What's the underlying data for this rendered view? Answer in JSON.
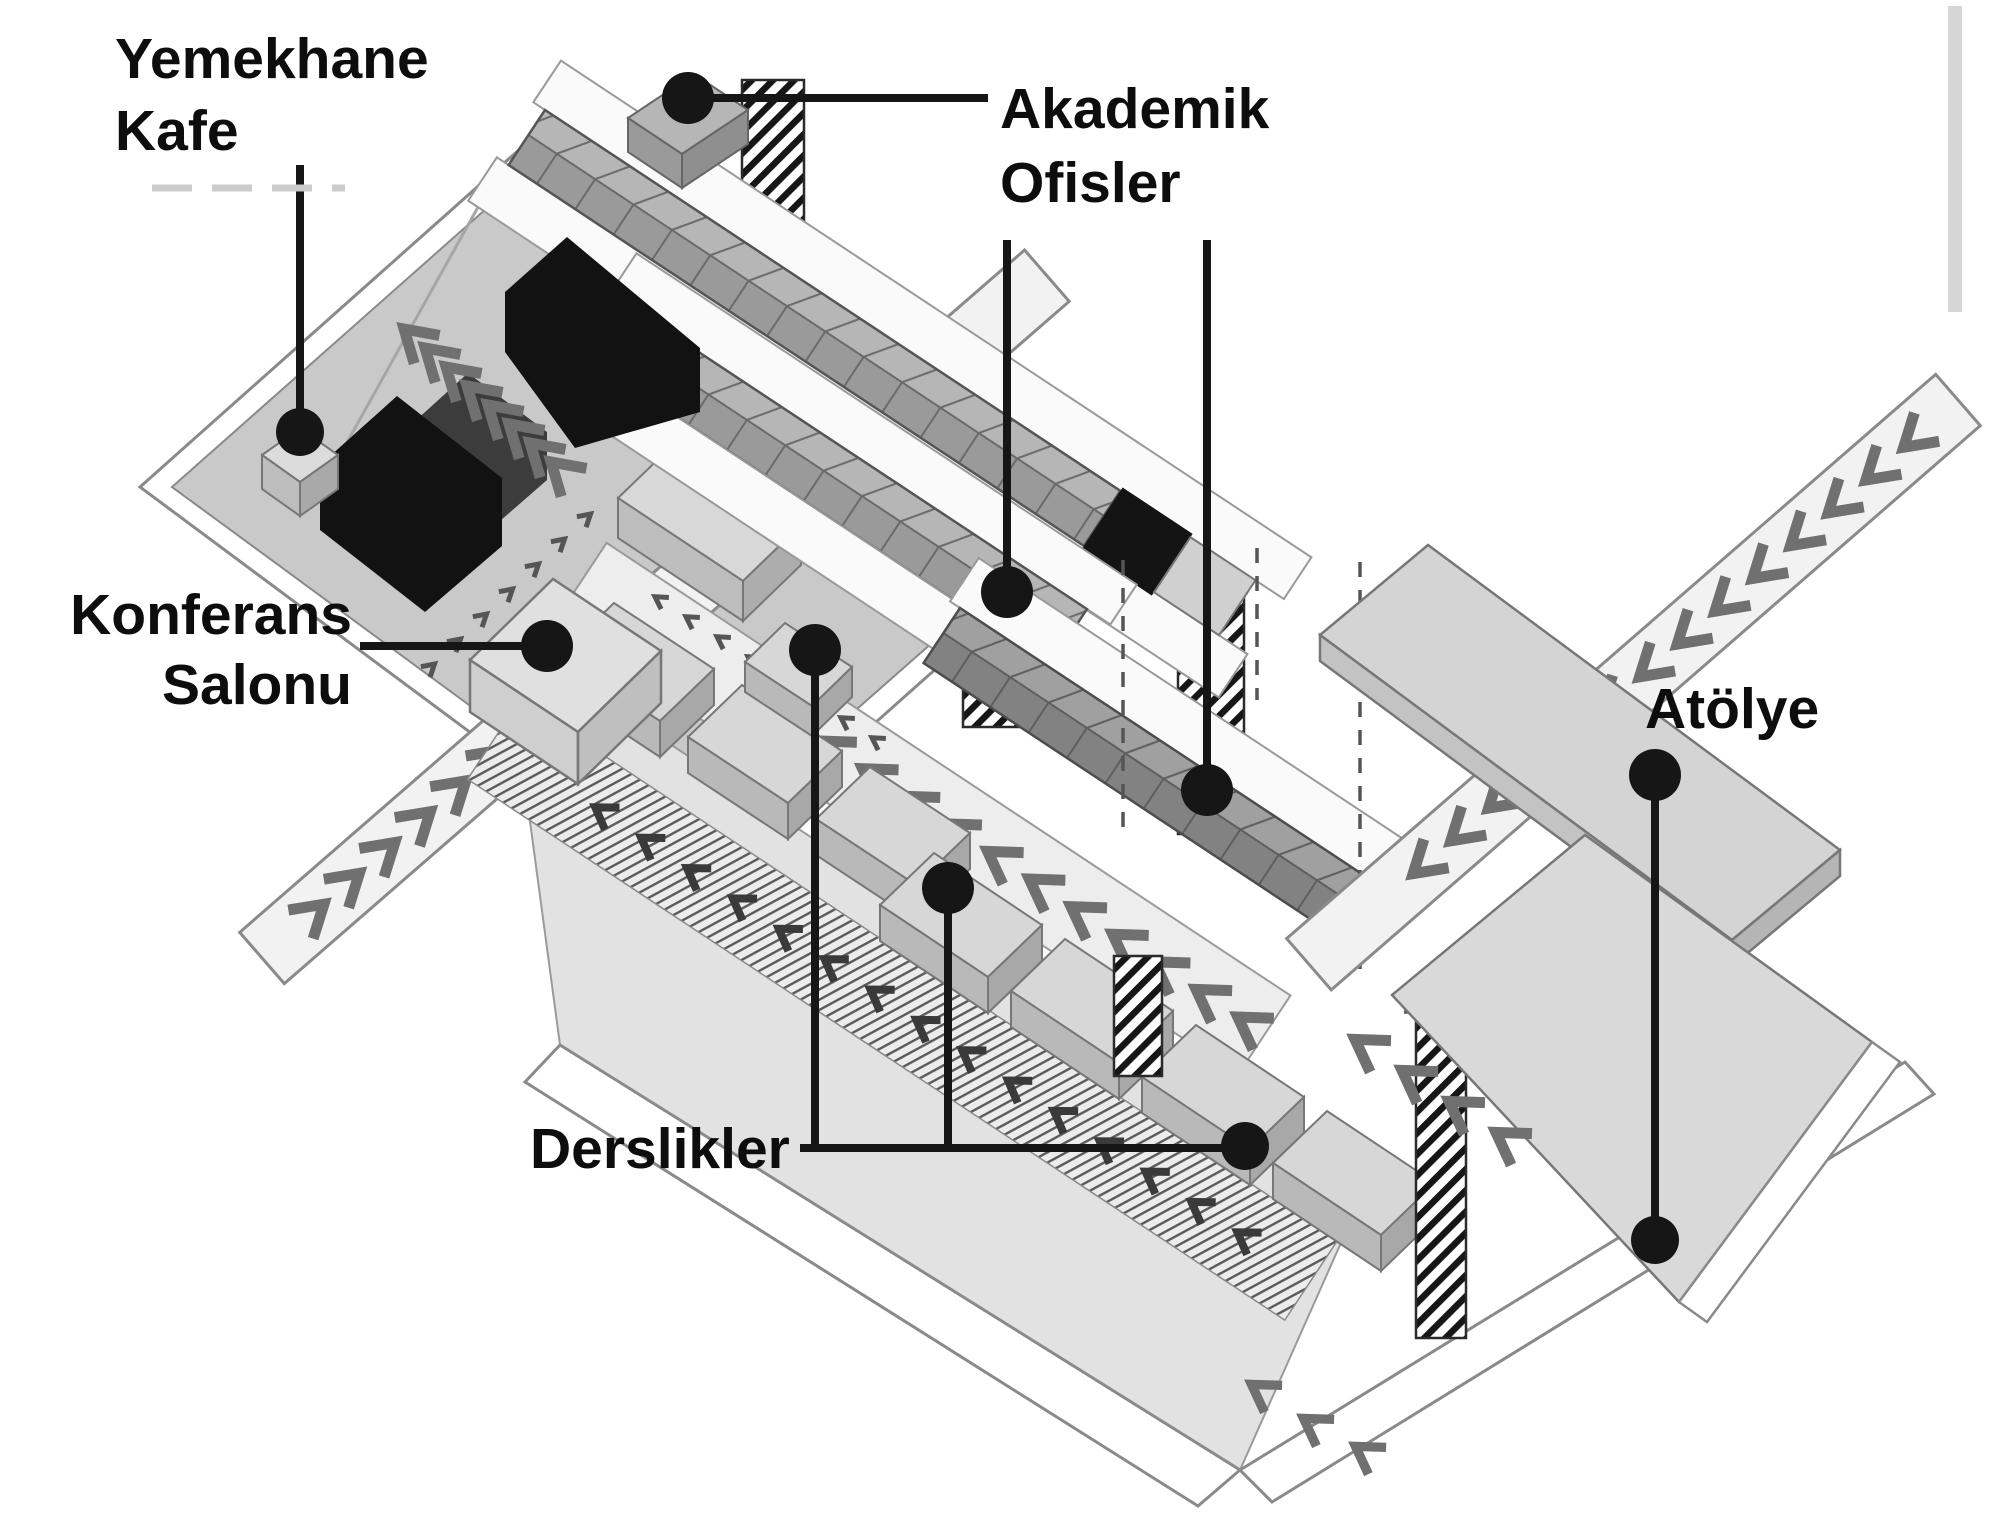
{
  "diagram": {
    "kind": "axonometric-campus-plan",
    "language": "tr",
    "labels": {
      "yemekhane": {
        "lines": [
          "Yemekhane",
          "Kafe"
        ]
      },
      "akademik": {
        "lines": [
          "Akademik",
          "Ofisler"
        ]
      },
      "konferans": {
        "lines": [
          "Konferans",
          "Salonu"
        ]
      },
      "derslikler": {
        "lines": [
          "Derslikler"
        ]
      },
      "atolye": {
        "lines": [
          "Atölye"
        ]
      }
    },
    "callouts": [
      {
        "name": "yemekhane-kafe",
        "dots": 1
      },
      {
        "name": "akademik-ofisler",
        "dots": 3
      },
      {
        "name": "konferans-salonu",
        "dots": 1
      },
      {
        "name": "derslikler",
        "dots": 3
      },
      {
        "name": "atolye",
        "dots": 2
      }
    ],
    "colors": {
      "ink": "#161616",
      "deck": "#c9c9c9",
      "terrace": "#e2e2e2",
      "walkway": "#fafafa",
      "office_top": "#b6b6b6",
      "office_front": "#9a9a9a",
      "office_dark_top": "#a0a0a0",
      "office_dark_front": "#828282",
      "slab_top": "#d7d7d7",
      "slab_front": "#b9b9b9",
      "roof": "#d4d4d4",
      "chevron": "#707070",
      "hatch": "#161616",
      "black_block": "#121212"
    }
  }
}
